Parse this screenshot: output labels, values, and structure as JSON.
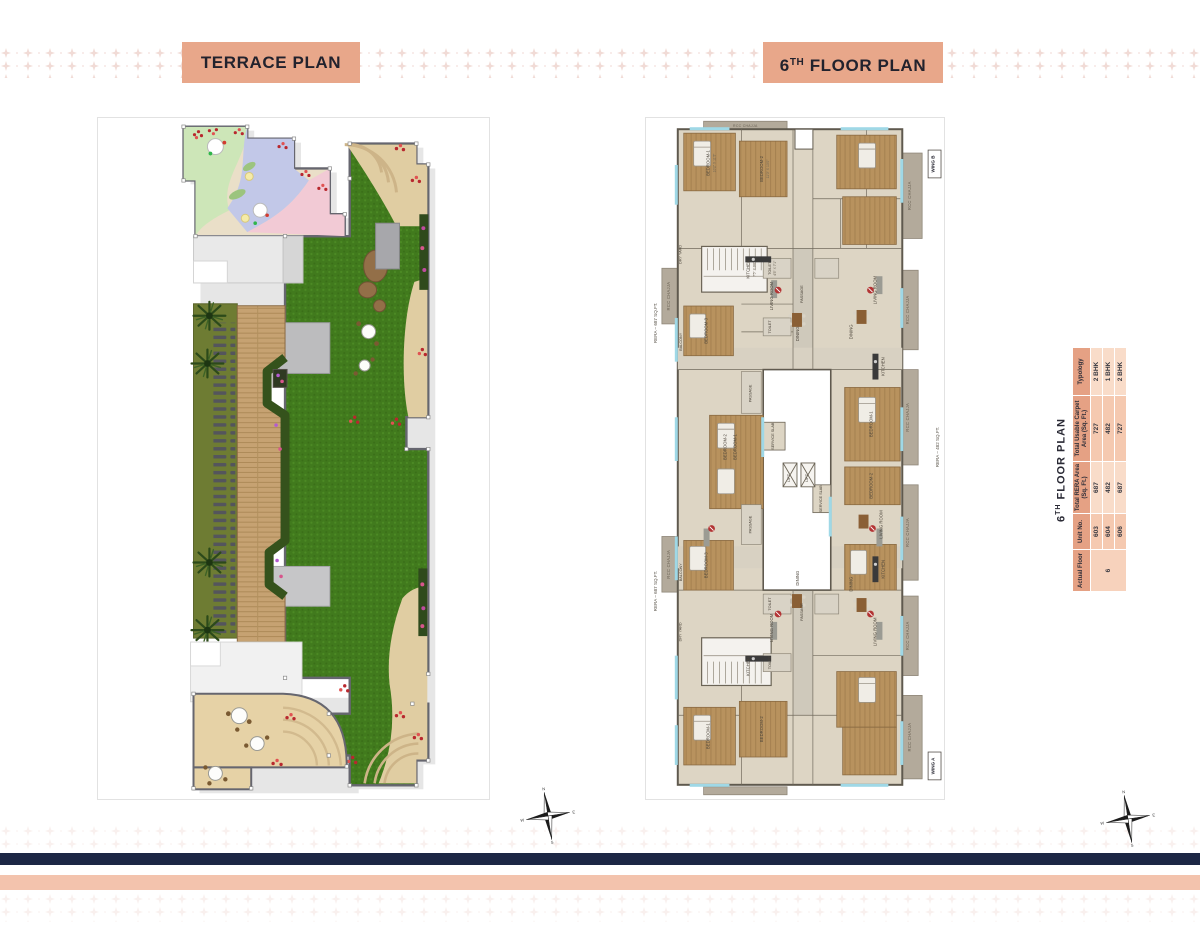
{
  "titles": {
    "left": "TERRACE PLAN",
    "right_num": "6",
    "right_sup": "TH",
    "right_rest": " FLOOR PLAN"
  },
  "unit_table": {
    "title_num": "6",
    "title_sup": "TH",
    "title_rest": " FLOOR PLAN",
    "columns": [
      "Actual Floor",
      "Unit No.",
      "Total RERA Area (Sq. Ft.)",
      "Total Usable Carpet Area (Sq. Ft.)",
      "Typology"
    ],
    "actual_floor": "6",
    "rows": [
      {
        "unit": "603",
        "rera": "687",
        "carpet": "727",
        "typology": "2 BHK"
      },
      {
        "unit": "604",
        "rera": "482",
        "carpet": "482",
        "typology": "1 BHK"
      },
      {
        "unit": "606",
        "rera": "687",
        "carpet": "727",
        "typology": "2 BHK"
      }
    ]
  },
  "floor_plan": {
    "wing_a": "WING A",
    "wing_b": "WING B",
    "rera_left": "RERA – 687 SQ.FT.",
    "rera_right": "RERA – 482 SQ.FT.",
    "rooms": {
      "bedroom1": "BEDROOM-1",
      "bedroom2": "BEDROOM-2",
      "bedroom3": "BEDROOM-3",
      "living": "LIVING ROOM",
      "kitchen": "KITCHEN",
      "dining": "DINING",
      "toilet": "TOILET",
      "passage": "PASSAGE",
      "service_slab": "SERVICE SLAB",
      "balcony": "BALCONY",
      "dry_yard": "DRY YARD",
      "rcc_chajja": "RCC CHAJJA",
      "lift": "LIFT"
    },
    "dims": {
      "bedroom1": "10'2\" X 11'5\"",
      "bedroom2": "11'0\" X 10'0\"",
      "kitchen": "7'5\" X 9'6\"",
      "toilet": "4'5\" X 7'1\""
    }
  },
  "compass": {
    "n": "N",
    "e": "E",
    "s": "S",
    "w": "W"
  }
}
